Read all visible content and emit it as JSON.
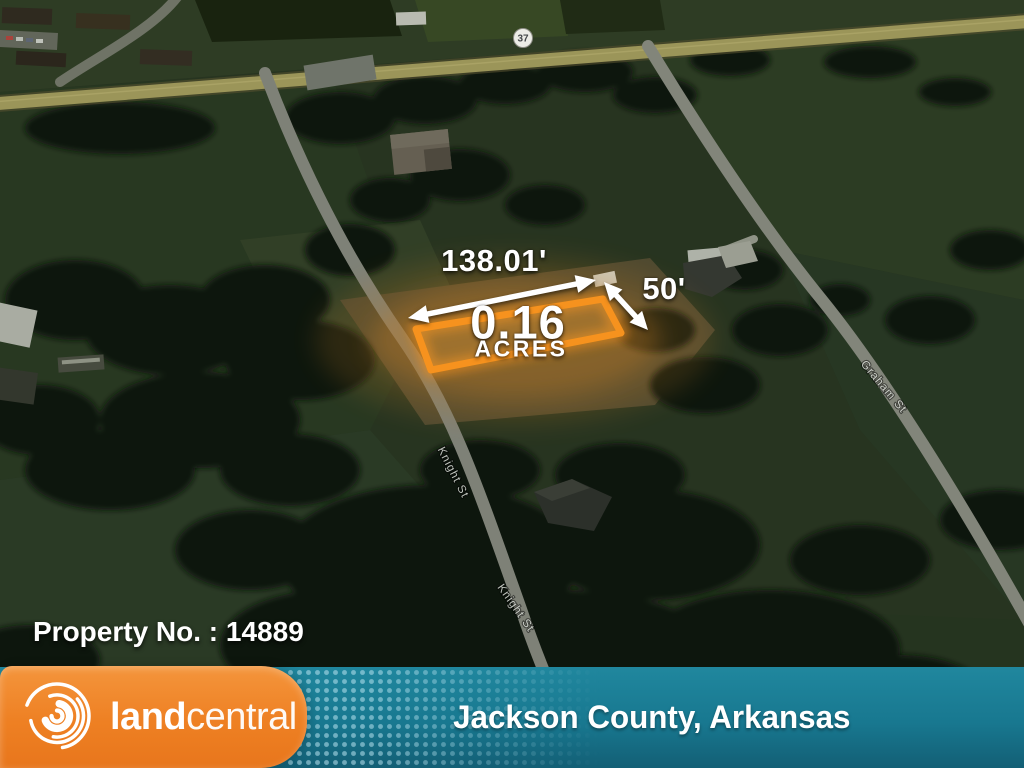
{
  "map": {
    "highway_badge": "37",
    "road_labels": [
      {
        "text": "Knight St"
      },
      {
        "text": "Knight St"
      },
      {
        "text": "Graham St"
      }
    ]
  },
  "parcel": {
    "width_label": "138.01'",
    "depth_label": "50'",
    "acreage_value": "0.16",
    "acreage_unit": "ACRES",
    "outline_color": "#f6921e"
  },
  "property": {
    "number_label": "Property No. : 14889"
  },
  "footer": {
    "brand_land": "land",
    "brand_central": "central",
    "location": "Jackson County, Arkansas",
    "brand_orange": "#ee8023",
    "banner_teal": "#187890"
  }
}
